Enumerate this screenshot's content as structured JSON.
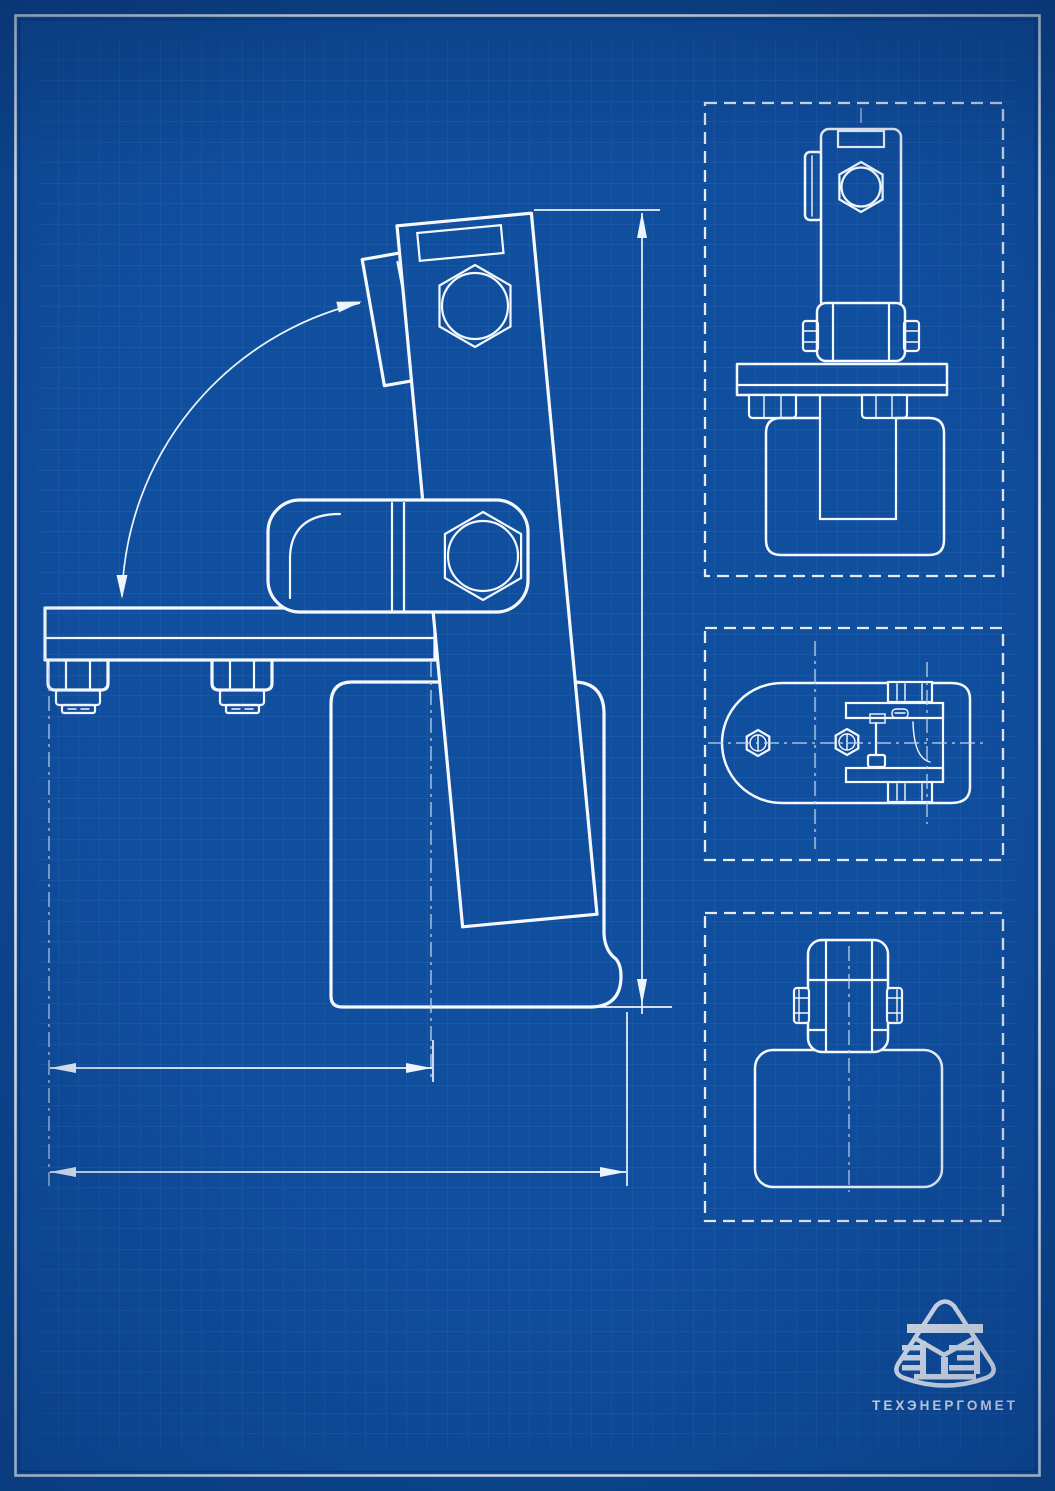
{
  "colors": {
    "background": "#104e9e",
    "background_outer": "#0d4791",
    "grid_line": "#3a72be",
    "line": "#f5f9fd",
    "centerline": "#bcd6f0",
    "dim_line": "#edf4fc",
    "vignette": "#042a63"
  },
  "logo": {
    "caption": "ТЕХЭНЕРГОМЕТ",
    "emblem": "te-monogram-shield"
  }
}
